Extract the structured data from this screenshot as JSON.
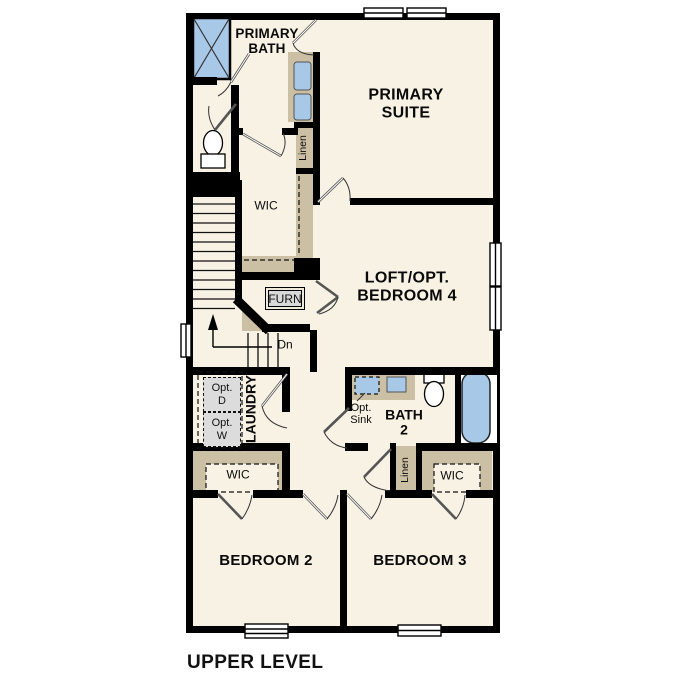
{
  "title": "UPPER LEVEL",
  "colors": {
    "floor": "#f8f2e4",
    "wall": "#000000",
    "cabinet_tan": "#cbc0a3",
    "fixture_blue": "#a8c8e8",
    "appliance_gray": "#dcdcdc"
  },
  "rooms": {
    "primary_bath": "PRIMARY\nBATH",
    "primary_suite": "PRIMARY\nSUITE",
    "wic_primary": "WIC",
    "loft": "LOFT/OPT.\nBEDROOM 4",
    "laundry": "LAUNDRY",
    "bath2": "BATH\n2",
    "wic_bedroom2": "WIC",
    "wic_bedroom3": "WIC",
    "bedroom2": "BEDROOM 2",
    "bedroom3": "BEDROOM 3"
  },
  "closets": {
    "linen_upper": "Linen",
    "linen_hall": "Linen"
  },
  "fixtures": {
    "furnace": "FURN",
    "opt_dryer": "Opt.\nD",
    "opt_washer": "Opt.\nW",
    "opt_sink": "Opt.\nSink"
  },
  "stairs": {
    "down_label": "Dn"
  }
}
